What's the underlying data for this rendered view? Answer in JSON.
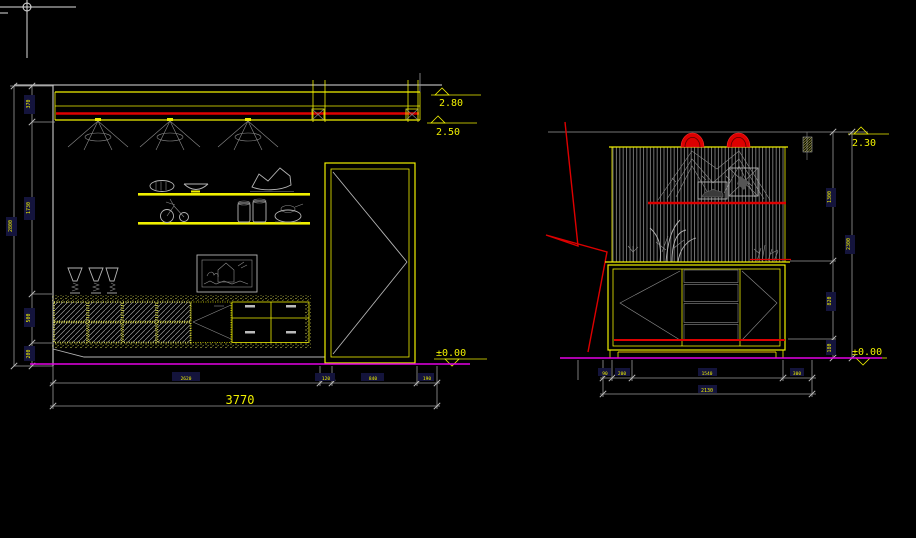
{
  "app": {
    "canvas_background": "#000000"
  },
  "colors": {
    "line_yellow": "#f0f000",
    "accent_red": "#dd0000",
    "floor_magenta": "#e400e4",
    "dim_gray": "#9a9a9a",
    "cursor_white": "#e8e8e8"
  },
  "left_elevation": {
    "title": "wall-elevation-with-door",
    "level_markers": [
      {
        "value": "2.80"
      },
      {
        "value": "2.50"
      },
      {
        "value": "±0.00"
      }
    ],
    "side_dims": {
      "segments": [
        "370",
        "1730",
        "500",
        "200"
      ],
      "overall": "2800"
    },
    "bottom_dims": {
      "segments": [
        "2620",
        "120",
        "840",
        "190"
      ],
      "total": "3770"
    }
  },
  "right_elevation": {
    "title": "sideboard-elevation",
    "level_markers": [
      {
        "value": "2.30"
      },
      {
        "value": "±0.00"
      }
    ],
    "side_dims": {
      "segments": [
        "1300",
        "820",
        "180"
      ],
      "overall": "2300"
    },
    "bottom_dims": {
      "segments": [
        "90",
        "200",
        "1540",
        "300"
      ],
      "total": "2130"
    }
  }
}
